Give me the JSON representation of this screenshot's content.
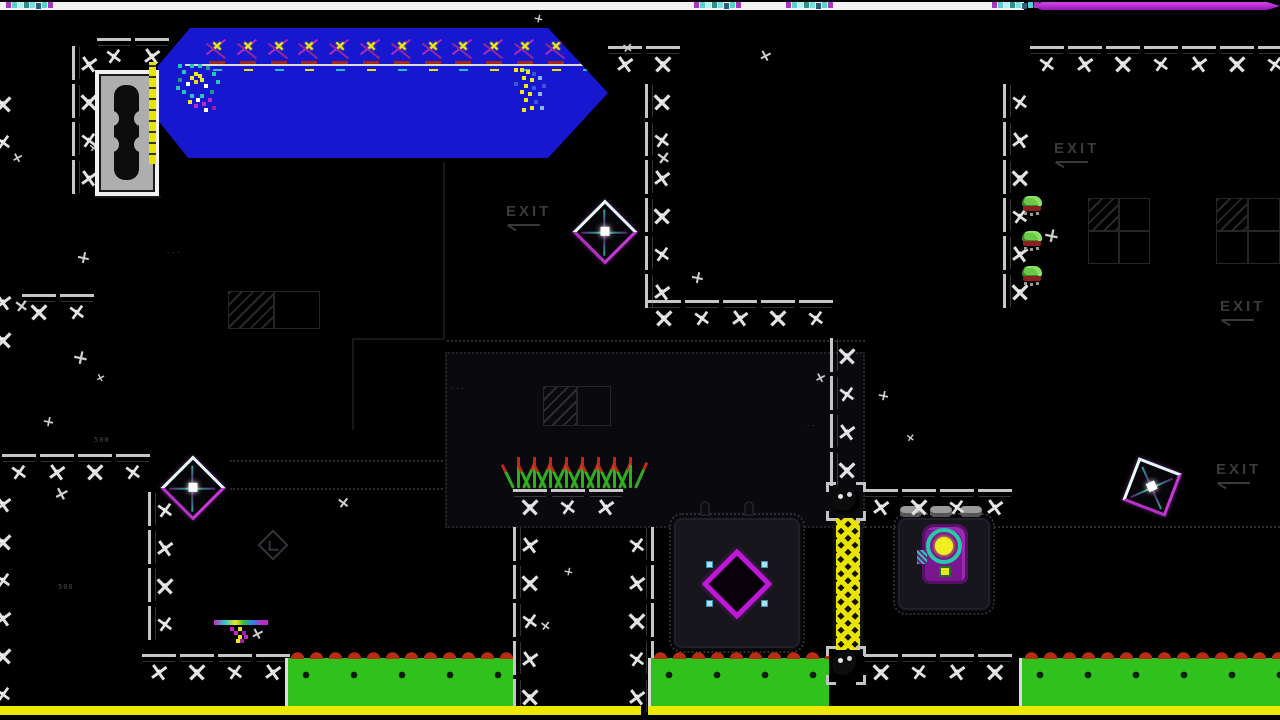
{
  "hud": {
    "top_strip": {
      "color": "#f2f2f2",
      "x": 0,
      "w": 1024
    },
    "progress_bar": {
      "color": "#a81cc8",
      "x": 1032,
      "w": 248
    },
    "bottom_bar_color": "#ece800",
    "bottom_bars": [
      {
        "x": 0,
        "w": 641
      },
      {
        "x": 648,
        "w": 632
      }
    ],
    "pixel_clusters": [
      {
        "x": 12
      },
      {
        "x": 700
      },
      {
        "x": 792
      },
      {
        "x": 998
      }
    ]
  },
  "colors": {
    "background": "#000000",
    "banner_blue": "#1717cf",
    "hazard_yellow": "#e8e400",
    "platform_green": "#2fc21c",
    "spike_red": "#bb2c14",
    "objective_magenta": "#c018d8",
    "hud_purple": "#a81cc8",
    "tile_white": "#d8d8d8"
  },
  "exits": [
    {
      "label": "EXIT",
      "x": 506,
      "y": 203
    },
    {
      "label": "EXIT",
      "x": 1054,
      "y": 140
    },
    {
      "label": "EXIT",
      "x": 1220,
      "y": 298
    },
    {
      "label": "EXIT",
      "x": 1216,
      "y": 461
    }
  ],
  "walls": [
    {
      "x": 0,
      "y": 452,
      "d": "h",
      "n": 4
    },
    {
      "x": 140,
      "y": 652,
      "d": "h",
      "n": 4
    },
    {
      "x": 511,
      "y": 487,
      "d": "h",
      "n": 3
    },
    {
      "x": 645,
      "y": 298,
      "d": "h",
      "n": 5
    },
    {
      "x": 606,
      "y": 44,
      "d": "h",
      "n": 2
    },
    {
      "x": 1028,
      "y": 44,
      "d": "h",
      "n": 7
    },
    {
      "x": 862,
      "y": 487,
      "d": "h",
      "n": 4
    },
    {
      "x": 862,
      "y": 652,
      "d": "h",
      "n": 4
    },
    {
      "x": 95,
      "y": 36,
      "d": "h",
      "n": 2
    },
    {
      "x": 20,
      "y": 292,
      "d": "h",
      "n": 2
    },
    {
      "x": 70,
      "y": 44,
      "d": "v",
      "n": 4,
      "s": "left"
    },
    {
      "x": 643,
      "y": 82,
      "d": "v",
      "n": 6,
      "s": "left"
    },
    {
      "x": 828,
      "y": 336,
      "d": "v",
      "n": 4,
      "s": "left"
    },
    {
      "x": 1001,
      "y": 82,
      "d": "v",
      "n": 6,
      "s": "left"
    },
    {
      "x": 146,
      "y": 490,
      "d": "v",
      "n": 4,
      "s": "left"
    },
    {
      "x": -16,
      "y": 484,
      "d": "v",
      "n": 6,
      "s": "left"
    },
    {
      "x": 511,
      "y": 525,
      "d": "v",
      "n": 5,
      "s": "left"
    },
    {
      "x": 618,
      "y": 525,
      "d": "v",
      "n": 5,
      "s": "right"
    },
    {
      "x": -16,
      "y": 84,
      "d": "v",
      "n": 2,
      "s": "left"
    },
    {
      "x": -16,
      "y": 282,
      "d": "v",
      "n": 2,
      "s": "left"
    }
  ],
  "stars": [
    [
      533,
      13
    ],
    [
      622,
      42
    ],
    [
      760,
      50
    ],
    [
      1046,
      230
    ],
    [
      88,
      142
    ],
    [
      12,
      152
    ],
    [
      78,
      252
    ],
    [
      16,
      300
    ],
    [
      95,
      372
    ],
    [
      43,
      416
    ],
    [
      338,
      497
    ],
    [
      56,
      488
    ],
    [
      563,
      566
    ],
    [
      540,
      620
    ],
    [
      252,
      628
    ],
    [
      75,
      352
    ],
    [
      905,
      432
    ],
    [
      815,
      372
    ],
    [
      692,
      272
    ],
    [
      658,
      152
    ],
    [
      365,
      131
    ],
    [
      878,
      390
    ]
  ],
  "glitch_text": [
    {
      "t": "500",
      "x": 94,
      "y": 436
    },
    {
      "t": "500",
      "x": 58,
      "y": 583
    },
    {
      "t": "...",
      "x": 166,
      "y": 247
    },
    {
      "t": "..",
      "x": 806,
      "y": 420
    },
    {
      "t": "...",
      "x": 450,
      "y": 383
    }
  ],
  "diamond_hazards": [
    {
      "x": 605,
      "y": 232,
      "rot": 45
    },
    {
      "x": 193,
      "y": 488,
      "rot": 45
    },
    {
      "x": 1152,
      "y": 487,
      "rot": 21
    }
  ],
  "objective": {
    "x": 737,
    "y": 584
  },
  "bugs": [
    {
      "x": 1020,
      "y": 196
    },
    {
      "x": 1020,
      "y": 231
    },
    {
      "x": 1020,
      "y": 266
    }
  ],
  "platforms": [
    {
      "x": 285,
      "w": 228
    },
    {
      "x": 648,
      "w": 181
    },
    {
      "x": 1019,
      "w": 261
    }
  ],
  "grass": [
    {
      "x": 511,
      "y": 452,
      "w": 128
    }
  ],
  "windows": [
    {
      "x": 1088,
      "y": 198,
      "w": 62,
      "h": 66,
      "c": 2,
      "r": 2
    },
    {
      "x": 1216,
      "y": 198,
      "w": 64,
      "h": 66,
      "c": 2,
      "r": 2
    },
    {
      "x": 228,
      "y": 291,
      "w": 92,
      "h": 38,
      "c": 2,
      "r": 1
    },
    {
      "x": 543,
      "y": 386,
      "w": 68,
      "h": 40,
      "c": 2,
      "r": 1
    }
  ],
  "dotted": [
    {
      "t": "r",
      "x": 445,
      "y": 352,
      "w": 420,
      "h": 176
    },
    {
      "t": "h",
      "x": 865,
      "y": 526,
      "w": 415
    },
    {
      "t": "h",
      "x": 230,
      "y": 460,
      "w": 213
    },
    {
      "t": "h",
      "x": 230,
      "y": 488,
      "w": 213
    },
    {
      "t": "h",
      "x": 447,
      "y": 340,
      "w": 418
    }
  ],
  "lines": [
    {
      "x": 443,
      "y": 162,
      "w": 2,
      "h": 178
    },
    {
      "x": 352,
      "y": 338,
      "w": 93,
      "h": 2
    },
    {
      "x": 352,
      "y": 338,
      "w": 2,
      "h": 92
    },
    {
      "x": 95,
      "y": 196,
      "w": 66,
      "h": 2
    }
  ],
  "pads": [
    {
      "x": 672,
      "y": 516,
      "w": 130,
      "h": 134
    },
    {
      "x": 896,
      "y": 516,
      "w": 96,
      "h": 96
    }
  ],
  "chimneys": [
    {
      "x": 700,
      "y": 501
    },
    {
      "x": 744,
      "y": 501
    }
  ],
  "cylinders": [
    {
      "x": 900,
      "y": 506
    },
    {
      "x": 930,
      "y": 506
    },
    {
      "x": 960,
      "y": 506
    }
  ],
  "ladder": {
    "x": 833,
    "y": 518,
    "w": 30,
    "h": 132
  },
  "balls": [
    {
      "x": 828,
      "y": 484
    },
    {
      "x": 828,
      "y": 648
    }
  ],
  "banner": {
    "x": 158,
    "y": 28,
    "w": 450,
    "h": 130,
    "spike_count": 13
  },
  "door": {
    "x": 95,
    "y": 70,
    "w": 64,
    "h": 126
  },
  "ystrip": {
    "x": 149,
    "y": 62,
    "w": 7,
    "h": 102
  },
  "icon_diamond": {
    "x": 262,
    "y": 534
  },
  "sprites": [
    {
      "type": "glitch-a",
      "name": "player-glitch-sprite",
      "x": 178,
      "y": 64
    },
    {
      "type": "glitch-b",
      "name": "clone-glitch-sprite",
      "x": 514,
      "y": 68
    },
    {
      "type": "glitch-c",
      "name": "pickup-glitch-sprite",
      "x": 214,
      "y": 620
    }
  ]
}
